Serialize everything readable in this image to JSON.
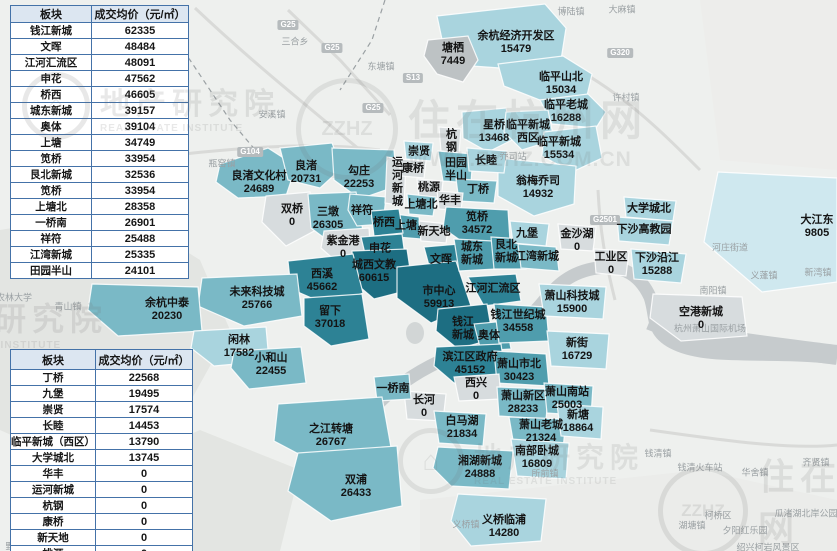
{
  "table1": {
    "col_plate": "板块",
    "col_price": "成交均价（元/㎡）",
    "rows": [
      [
        "钱江新城",
        "62335"
      ],
      [
        "文晖",
        "48484"
      ],
      [
        "江河汇流区",
        "48091"
      ],
      [
        "申花",
        "47562"
      ],
      [
        "桥西",
        "46605"
      ],
      [
        "城东新城",
        "39157"
      ],
      [
        "奥体",
        "39104"
      ],
      [
        "上塘",
        "34749"
      ],
      [
        "笕桥",
        "33954"
      ],
      [
        "艮北新城",
        "32536"
      ],
      [
        "笕桥",
        "33954"
      ],
      [
        "上塘北",
        "28358"
      ],
      [
        "一桥南",
        "26901"
      ],
      [
        "祥符",
        "25488"
      ],
      [
        "江湾新城",
        "25335"
      ],
      [
        "田园半山",
        "24101"
      ]
    ]
  },
  "table2": {
    "col_plate": "板块",
    "col_price": "成交均价（元/㎡）",
    "rows": [
      [
        "丁桥",
        "22568"
      ],
      [
        "九堡",
        "19495"
      ],
      [
        "崇贤",
        "17574"
      ],
      [
        "长睦",
        "14453"
      ],
      [
        "临平新城（西区）",
        "13790"
      ],
      [
        "大学城北",
        "13745"
      ],
      [
        "华丰",
        "0"
      ],
      [
        "运河新城",
        "0"
      ],
      [
        "杭钢",
        "0"
      ],
      [
        "康桥",
        "0"
      ],
      [
        "新天地",
        "0"
      ],
      [
        "桃源",
        "0"
      ]
    ]
  },
  "map": {
    "regions": [
      {
        "id": "tangqi",
        "name": "塘栖",
        "price": "7449"
      },
      {
        "id": "yuhang-kaifaqu",
        "name": "余杭经济开发区",
        "price": "15479"
      },
      {
        "id": "linping-shanbei",
        "name": "临平山北",
        "price": "15034"
      },
      {
        "id": "linping-laocheng",
        "name": "临平老城",
        "price": "16288"
      },
      {
        "id": "xingqiao",
        "name": "星桥",
        "price": "13468"
      },
      {
        "id": "linping-xiqu",
        "name": "临平新城西区",
        "price": ""
      },
      {
        "id": "linping-xincheng",
        "name": "临平新城",
        "price": "15534"
      },
      {
        "id": "wengmei-qiaosi",
        "name": "翁梅乔司",
        "price": "14932"
      },
      {
        "id": "liangzhu-wenhuacun",
        "name": "良渚文化村",
        "price": "24689"
      },
      {
        "id": "liangzhu",
        "name": "良渚",
        "price": "20731"
      },
      {
        "id": "gouzhuang",
        "name": "勾庄",
        "price": "22253"
      },
      {
        "id": "shuangqiao",
        "name": "双桥",
        "price": "0"
      },
      {
        "id": "sandun",
        "name": "三墩",
        "price": "26305"
      },
      {
        "id": "xiangfu",
        "name": "祥符",
        "price": ""
      },
      {
        "id": "zijingang",
        "name": "紫金港",
        "price": "0"
      },
      {
        "id": "chongxian",
        "name": "崇贤",
        "price": ""
      },
      {
        "id": "yunhe-xincheng",
        "name": "运河新城",
        "price": ""
      },
      {
        "id": "kangqiao",
        "name": "康桥",
        "price": ""
      },
      {
        "id": "taoyuan",
        "name": "桃源",
        "price": ""
      },
      {
        "id": "hanggang",
        "name": "杭钢",
        "price": ""
      },
      {
        "id": "tianyuan-banshan",
        "name": "田园半山",
        "price": ""
      },
      {
        "id": "changmu",
        "name": "长睦",
        "price": ""
      },
      {
        "id": "dingqiao",
        "name": "丁桥",
        "price": ""
      },
      {
        "id": "huafeng",
        "name": "华丰",
        "price": ""
      },
      {
        "id": "shangtangbei",
        "name": "上塘北",
        "price": ""
      },
      {
        "id": "shangtang",
        "name": "上塘",
        "price": ""
      },
      {
        "id": "qiaoxi",
        "name": "桥西",
        "price": ""
      },
      {
        "id": "xintiandi",
        "name": "新天地",
        "price": ""
      },
      {
        "id": "jianqiao",
        "name": "笕桥",
        "price": "34572"
      },
      {
        "id": "shenhua",
        "name": "申花",
        "price": ""
      },
      {
        "id": "chengxi-wenjiao",
        "name": "城西文教",
        "price": "60615"
      },
      {
        "id": "xixi",
        "name": "西溪",
        "price": "45662"
      },
      {
        "id": "weilai-kejicheng",
        "name": "未来科技城",
        "price": "25766"
      },
      {
        "id": "yuhang-zhongtai",
        "name": "余杭中泰",
        "price": "20230"
      },
      {
        "id": "xianlin",
        "name": "闲林",
        "price": "17582"
      },
      {
        "id": "xiaoheshan",
        "name": "小和山",
        "price": "22455"
      },
      {
        "id": "liuxia",
        "name": "留下",
        "price": "37018"
      },
      {
        "id": "wenhui",
        "name": "文晖",
        "price": ""
      },
      {
        "id": "shizhongxin",
        "name": "市中心",
        "price": "59913"
      },
      {
        "id": "chengdong-xincheng",
        "name": "城东新城",
        "price": ""
      },
      {
        "id": "genbei-xincheng",
        "name": "艮北新城",
        "price": ""
      },
      {
        "id": "jiangwan-xincheng",
        "name": "江湾新城",
        "price": ""
      },
      {
        "id": "jiubao",
        "name": "九堡",
        "price": ""
      },
      {
        "id": "jinshahu",
        "name": "金沙湖",
        "price": "0"
      },
      {
        "id": "daxuechengbei",
        "name": "大学城北",
        "price": ""
      },
      {
        "id": "xiasha-gaojiaoyuan",
        "name": "下沙高教园",
        "price": ""
      },
      {
        "id": "gongyequ",
        "name": "工业区",
        "price": "0"
      },
      {
        "id": "xiasha-yanjiang",
        "name": "下沙沿江",
        "price": "15288"
      },
      {
        "id": "dajiangdong",
        "name": "大江东",
        "price": "9805"
      },
      {
        "id": "konggang-xincheng",
        "name": "空港新城",
        "price": "0"
      },
      {
        "id": "jianghe-huiliuqu",
        "name": "江河汇流区",
        "price": ""
      },
      {
        "id": "qianjiang-xincheng",
        "name": "钱江新城",
        "price": ""
      },
      {
        "id": "aoti",
        "name": "奥体",
        "price": ""
      },
      {
        "id": "qianjiang-shijicheng",
        "name": "钱江世纪城",
        "price": "34558"
      },
      {
        "id": "xiaoshan-kejicheng",
        "name": "萧山科技城",
        "price": "15900"
      },
      {
        "id": "xinjie",
        "name": "新街",
        "price": "16729"
      },
      {
        "id": "binjiang-quzhengfu",
        "name": "滨江区政府",
        "price": "45152"
      },
      {
        "id": "xiaoshan-shibei",
        "name": "萧山市北",
        "price": "30423"
      },
      {
        "id": "xixing",
        "name": "西兴",
        "price": "0"
      },
      {
        "id": "changhe",
        "name": "长河",
        "price": "0"
      },
      {
        "id": "yiqiaonan",
        "name": "一桥南",
        "price": ""
      },
      {
        "id": "zhijiang-zhuantang",
        "name": "之江转塘",
        "price": "26767"
      },
      {
        "id": "shuangpu",
        "name": "双浦",
        "price": "26433"
      },
      {
        "id": "baimahu",
        "name": "白马湖",
        "price": "21834"
      },
      {
        "id": "xiaoshan-xinqu",
        "name": "萧山新区",
        "price": "28233"
      },
      {
        "id": "xiaoshan-nanzhan",
        "name": "萧山南站",
        "price": "25003"
      },
      {
        "id": "xiaoshan-laocheng",
        "name": "萧山老城",
        "price": "21324"
      },
      {
        "id": "xintang",
        "name": "新塘",
        "price": "18864"
      },
      {
        "id": "xianghu-xincheng",
        "name": "湘湖新城",
        "price": "24888"
      },
      {
        "id": "nanbu-wocheng",
        "name": "南部卧城",
        "price": "16809"
      },
      {
        "id": "yiqiao-linpu",
        "name": "义桥临浦",
        "price": "14280"
      }
    ]
  },
  "background": {
    "towns": [
      "上柏镇站",
      "三合乡",
      "东塘镇",
      "安溪镇",
      "瓶窑镇",
      "青山镇",
      "农林大学",
      "博陆镇",
      "大麻镇",
      "许村镇",
      "乔司站",
      "河庄街道",
      "义蓬镇",
      "新湾镇",
      "南阳镇",
      "杭州萧山国际机场",
      "所前镇",
      "义桥镇",
      "钱清镇",
      "钱清火车站",
      "华舍镇",
      "齐贤镇",
      "柯桥区",
      "湖塘镇",
      "夕阳红乐园",
      "瓜渚湖北岸公园",
      "绍兴柯岩风景区",
      "野生动物园"
    ],
    "badges": [
      "G25",
      "G25",
      "G25",
      "G104",
      "S13",
      "G320",
      "G2501"
    ]
  },
  "watermark": {
    "institute_cn": "地产研究院",
    "institute_en": "REAL ESTATE INSTITUTE",
    "site_cn": "住在杭州网",
    "site_url": "WWW.ZZHZ.COM.CN",
    "logo_short": "ZZHZ",
    "house_glyph": "⌂"
  }
}
